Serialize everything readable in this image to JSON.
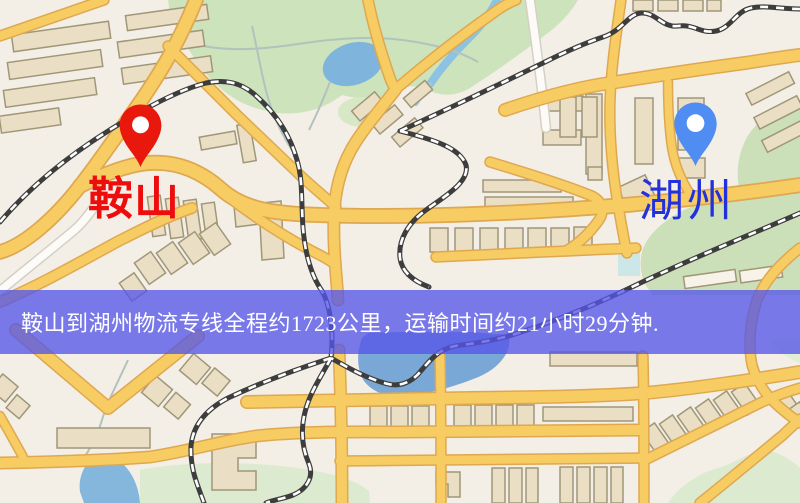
{
  "origin": {
    "label": "鞍山",
    "pin_color": "#e8190c",
    "label_color": "#ee0d0d"
  },
  "destination": {
    "label": "湖州",
    "pin_color": "#4f8df2",
    "label_color": "#2331dd"
  },
  "banner": {
    "text": "鞍山到湖州物流专线全程约1723公里，运输时间约21小时29分钟.",
    "background_rgba": "rgba(86,86,232,0.78)",
    "text_color": "#ffffff",
    "distance_km": "1723",
    "duration_text": "21小时29分钟"
  },
  "map_palette": {
    "base": "#f3efe6",
    "road_yellow": "#f6cc63",
    "road_casing": "#dfa850",
    "railway": "#3d3d3d",
    "water": "#7fb5dc",
    "park_green": "#cde3bb",
    "building": "#eadfc4"
  }
}
